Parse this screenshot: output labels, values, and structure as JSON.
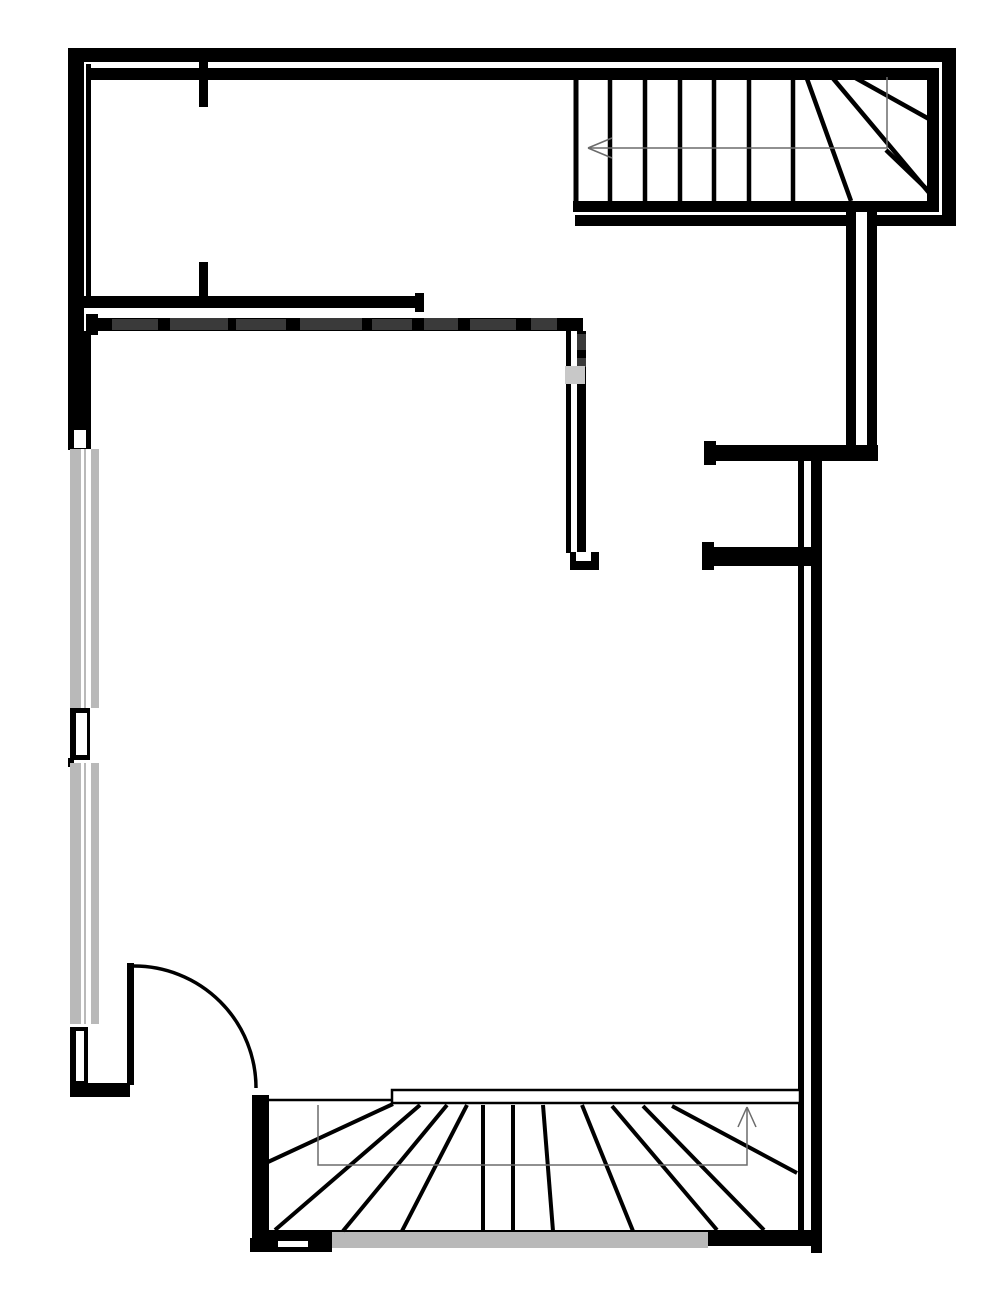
{
  "palette": {
    "wall": "#000000",
    "white": "#ffffff",
    "window": "#b9b9b9",
    "guide": "#6b6b6b",
    "wmdark": "#3a3a3a",
    "wmlight": "#c8c8c8",
    "background": "#ffffff"
  },
  "plan": {
    "width": 1000,
    "height": 1292,
    "rects": [
      [
        "outer-top-wall",
        68,
        48,
        888,
        14,
        "wall"
      ],
      [
        "outer-right-wall",
        942,
        48,
        14,
        178,
        "wall"
      ],
      [
        "inner-top-wall",
        88,
        68,
        851,
        12,
        "wall"
      ],
      [
        "stair-inner-right-wall",
        927,
        68,
        12,
        144,
        "wall"
      ],
      [
        "stair-inner-bottom-wall",
        573,
        201,
        366,
        11,
        "wall"
      ],
      [
        "stair-outer-bottom-wall-left",
        575,
        215,
        273,
        11,
        "wall"
      ],
      [
        "stair-outer-bottom-wall-right",
        870,
        215,
        86,
        11,
        "wall"
      ],
      [
        "outer-left-wall",
        68,
        48,
        16,
        402,
        "wall"
      ],
      [
        "left-inner-wall-line",
        86,
        64,
        5,
        232,
        "wall"
      ],
      [
        "door-jamb-stub-top",
        199,
        62,
        9,
        45,
        "wall"
      ],
      [
        "door-jamb-stub-mid",
        199,
        262,
        9,
        36,
        "wall"
      ],
      [
        "interior-wall-a",
        82,
        296,
        342,
        12,
        "wall"
      ],
      [
        "interior-wall-a-cap",
        415,
        293,
        9,
        19,
        "wall"
      ],
      [
        "interior-wall-b",
        88,
        318,
        495,
        13,
        "wall"
      ],
      [
        "interior-wall-b-cap",
        86,
        314,
        12,
        21,
        "wall"
      ],
      [
        "left-wall-lower",
        68,
        331,
        23,
        118,
        "wall"
      ],
      [
        "mid-wall-thin",
        566,
        331,
        5,
        222,
        "wall"
      ],
      [
        "mid-wall-thick",
        577,
        331,
        9,
        222,
        "wall"
      ],
      [
        "mid-wall-foot",
        570,
        552,
        29,
        18,
        "wall"
      ],
      [
        "right-upper-vert-wall-1",
        846,
        212,
        10,
        235,
        "wall"
      ],
      [
        "right-upper-vert-wall-2",
        867,
        212,
        10,
        235,
        "wall"
      ],
      [
        "right-mid-horizontal-wall",
        706,
        445,
        172,
        16,
        "wall"
      ],
      [
        "right-mid-horizontal-cap",
        704,
        441,
        12,
        24,
        "wall"
      ],
      [
        "lower-vert-wall-thin",
        798,
        461,
        6,
        770,
        "wall"
      ],
      [
        "lower-vert-wall-thick",
        811,
        461,
        11,
        792,
        "wall"
      ],
      [
        "door-stub-wall",
        704,
        547,
        108,
        19,
        "wall"
      ],
      [
        "door-stub-cap",
        702,
        542,
        12,
        28,
        "wall"
      ],
      [
        "window-pier-black",
        70,
        708,
        20,
        52,
        "wall"
      ],
      [
        "window-pier-tick",
        68,
        758,
        6,
        9,
        "wall"
      ],
      [
        "left-corner-wall",
        70,
        1027,
        18,
        70,
        "wall"
      ],
      [
        "left-corner-wall-horizontal",
        70,
        1083,
        60,
        14,
        "wall"
      ],
      [
        "door-leaf",
        127,
        963,
        7,
        122,
        "wall"
      ],
      [
        "bstair-left-wall",
        252,
        1095,
        17,
        151,
        "wall"
      ],
      [
        "bstair-bottom-wall",
        256,
        1230,
        566,
        16,
        "wall"
      ],
      [
        "bstair-bottom-left-piece",
        250,
        1238,
        82,
        14,
        "wall"
      ],
      [
        "window-left-1",
        70,
        449,
        29,
        259,
        "window"
      ],
      [
        "window-left-1-glass",
        81,
        449,
        10,
        259,
        "white"
      ],
      [
        "window-left-1-mullion",
        84,
        449,
        2,
        259,
        "window"
      ],
      [
        "window-left-2",
        70,
        763,
        29,
        261,
        "window"
      ],
      [
        "window-left-2-glass",
        81,
        763,
        10,
        261,
        "white"
      ],
      [
        "window-left-2-mullion",
        84,
        763,
        2,
        261,
        "window"
      ],
      [
        "window-bottom",
        332,
        1232,
        376,
        16,
        "window"
      ],
      [
        "left-wall-notch",
        74,
        430,
        12,
        18,
        "white"
      ],
      [
        "window-pier-glass",
        76,
        713,
        11,
        42,
        "white"
      ],
      [
        "left-corner-slit",
        76,
        1031,
        8,
        50,
        "white"
      ],
      [
        "mid-wall-foot-notch",
        576,
        552,
        15,
        9,
        "white"
      ],
      [
        "bottom-left-notch",
        278,
        1241,
        30,
        6,
        "white"
      ],
      [
        "watermark-1",
        112,
        319,
        46,
        11,
        "wmdark"
      ],
      [
        "watermark-2",
        170,
        318,
        58,
        12,
        "wmdark"
      ],
      [
        "watermark-3",
        236,
        319,
        50,
        11,
        "wmdark"
      ],
      [
        "watermark-4",
        300,
        318,
        62,
        12,
        "wmdark"
      ],
      [
        "watermark-5",
        372,
        319,
        40,
        11,
        "wmdark"
      ],
      [
        "watermark-6",
        424,
        318,
        34,
        12,
        "wmdark"
      ],
      [
        "watermark-7",
        470,
        319,
        46,
        11,
        "wmdark"
      ],
      [
        "watermark-8",
        531,
        318,
        26,
        12,
        "wmdark"
      ],
      [
        "watermark-9",
        577,
        334,
        9,
        16,
        "wmdark"
      ],
      [
        "watermark-10",
        577,
        358,
        9,
        9,
        "wmdark"
      ],
      [
        "watermark-light-glyph",
        565,
        366,
        20,
        18,
        "wmlight"
      ],
      [
        "stair-landing-bar",
        392,
        1090,
        408,
        13,
        "white",
        "wall",
        2.5
      ]
    ],
    "lines": [
      [
        "tstair-left-edge",
        576,
        80,
        576,
        201,
        5,
        "wall"
      ],
      [
        "tstair-tread-1",
        610,
        80,
        610,
        201,
        4.5,
        "wall"
      ],
      [
        "tstair-tread-2",
        645,
        80,
        645,
        201,
        4.5,
        "wall"
      ],
      [
        "tstair-tread-3",
        680,
        80,
        680,
        201,
        4.5,
        "wall"
      ],
      [
        "tstair-tread-4",
        714,
        80,
        714,
        201,
        4.5,
        "wall"
      ],
      [
        "tstair-tread-5",
        749,
        80,
        749,
        201,
        4.5,
        "wall"
      ],
      [
        "tstair-tread-6",
        793,
        80,
        793,
        201,
        4.5,
        "wall"
      ],
      [
        "tstair-winder-1",
        806,
        76,
        851,
        201,
        4.5,
        "wall"
      ],
      [
        "tstair-winder-2",
        831,
        76,
        936,
        201,
        4.5,
        "wall"
      ],
      [
        "tstair-winder-3",
        852,
        76,
        938,
        124,
        4.5,
        "wall"
      ],
      [
        "tstair-winder-4",
        886,
        150,
        936,
        198,
        4.5,
        "wall"
      ],
      [
        "bstair-top-line",
        267,
        1100,
        392,
        1100,
        2.5,
        "wall"
      ],
      [
        "bstair-fan-1",
        268,
        1162,
        393,
        1104,
        4,
        "wall"
      ],
      [
        "bstair-fan-2",
        275,
        1230,
        420,
        1105,
        4,
        "wall"
      ],
      [
        "bstair-fan-3",
        343,
        1231,
        447,
        1105,
        4,
        "wall"
      ],
      [
        "bstair-fan-4",
        402,
        1231,
        467,
        1105,
        4,
        "wall"
      ],
      [
        "bstair-fan-5",
        483,
        1231,
        483,
        1105,
        4,
        "wall"
      ],
      [
        "bstair-fan-6",
        513,
        1231,
        513,
        1105,
        4,
        "wall"
      ],
      [
        "bstair-fan-7",
        553,
        1231,
        543,
        1105,
        4,
        "wall"
      ],
      [
        "bstair-fan-8",
        633,
        1231,
        582,
        1105,
        4,
        "wall"
      ],
      [
        "bstair-fan-9",
        717,
        1230,
        612,
        1106,
        4,
        "wall"
      ],
      [
        "bstair-fan-10",
        764,
        1230,
        643,
        1106,
        4,
        "wall"
      ],
      [
        "bstair-fan-11",
        797,
        1173,
        672,
        1106,
        4,
        "wall"
      ],
      [
        "tstair-arrow-arm-1",
        588,
        148,
        612,
        138,
        1.5,
        "guide"
      ],
      [
        "tstair-arrow-arm-2",
        588,
        148,
        612,
        158,
        1.5,
        "guide"
      ],
      [
        "bstair-arrow-arm-1",
        747,
        1107,
        738,
        1127,
        1.5,
        "guide"
      ],
      [
        "bstair-arrow-arm-2",
        747,
        1107,
        756,
        1127,
        1.5,
        "guide"
      ]
    ],
    "polylines": [
      [
        "tstair-direction-guide",
        "887,77 887,148 588,148",
        1.5,
        "guide"
      ],
      [
        "bstair-direction-guide",
        "318,1105 318,1165 747,1165 747,1107",
        1.5,
        "guide"
      ]
    ],
    "paths": [
      [
        "door-swing-arc",
        "M 134 966 A 122 122 0 0 1 256 1088",
        3.5,
        "wall"
      ]
    ]
  }
}
